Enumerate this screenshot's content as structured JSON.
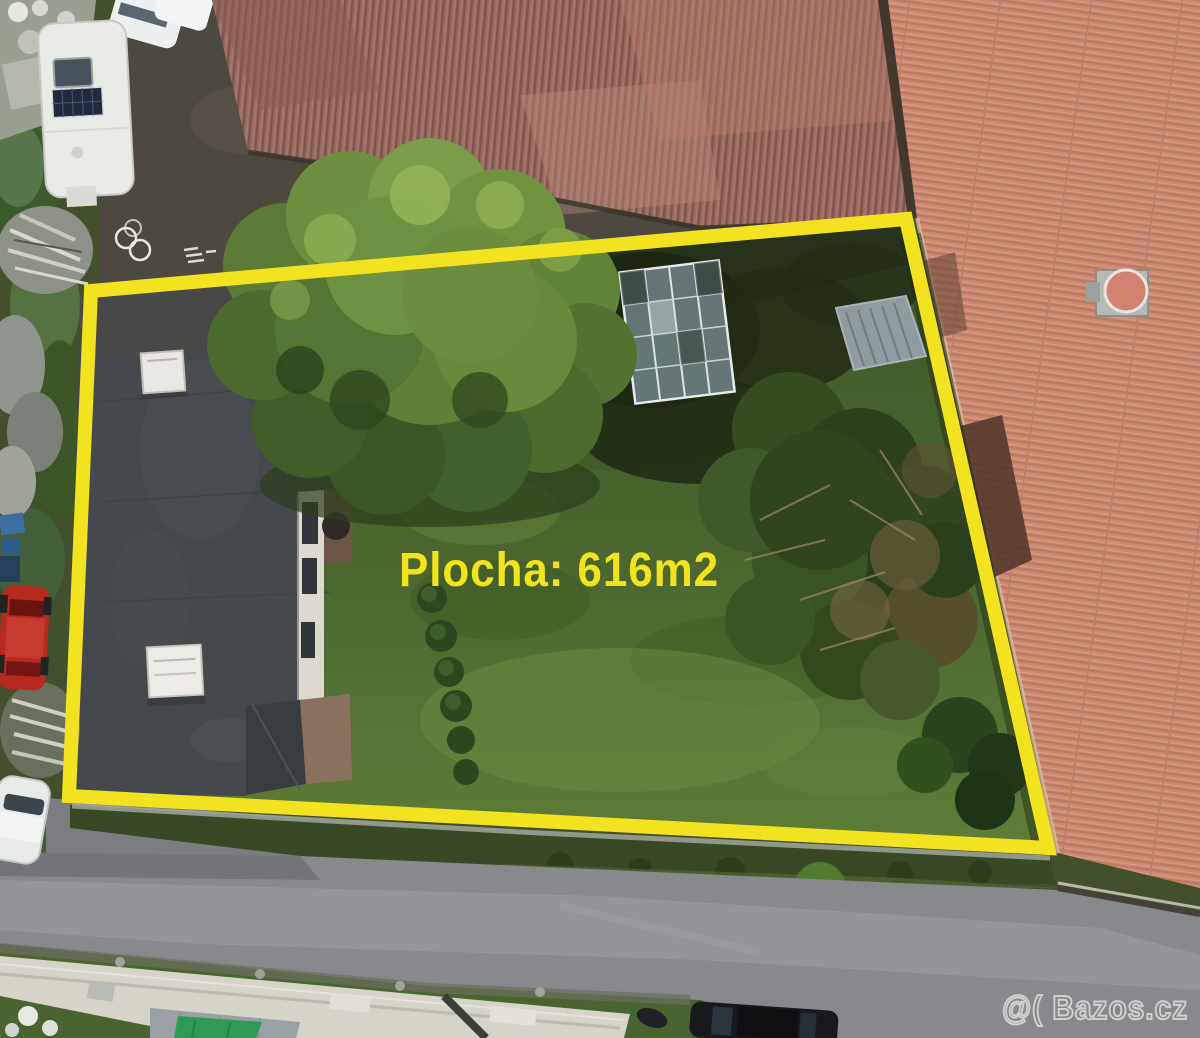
{
  "annotation": {
    "label_text": "Plocha: 616m2",
    "label_color": "#f2e41c",
    "boundary_color": "#f2e21f"
  },
  "watermark": {
    "text": "@( Bazos.cz",
    "stroke_color": "#e9e9e6"
  }
}
